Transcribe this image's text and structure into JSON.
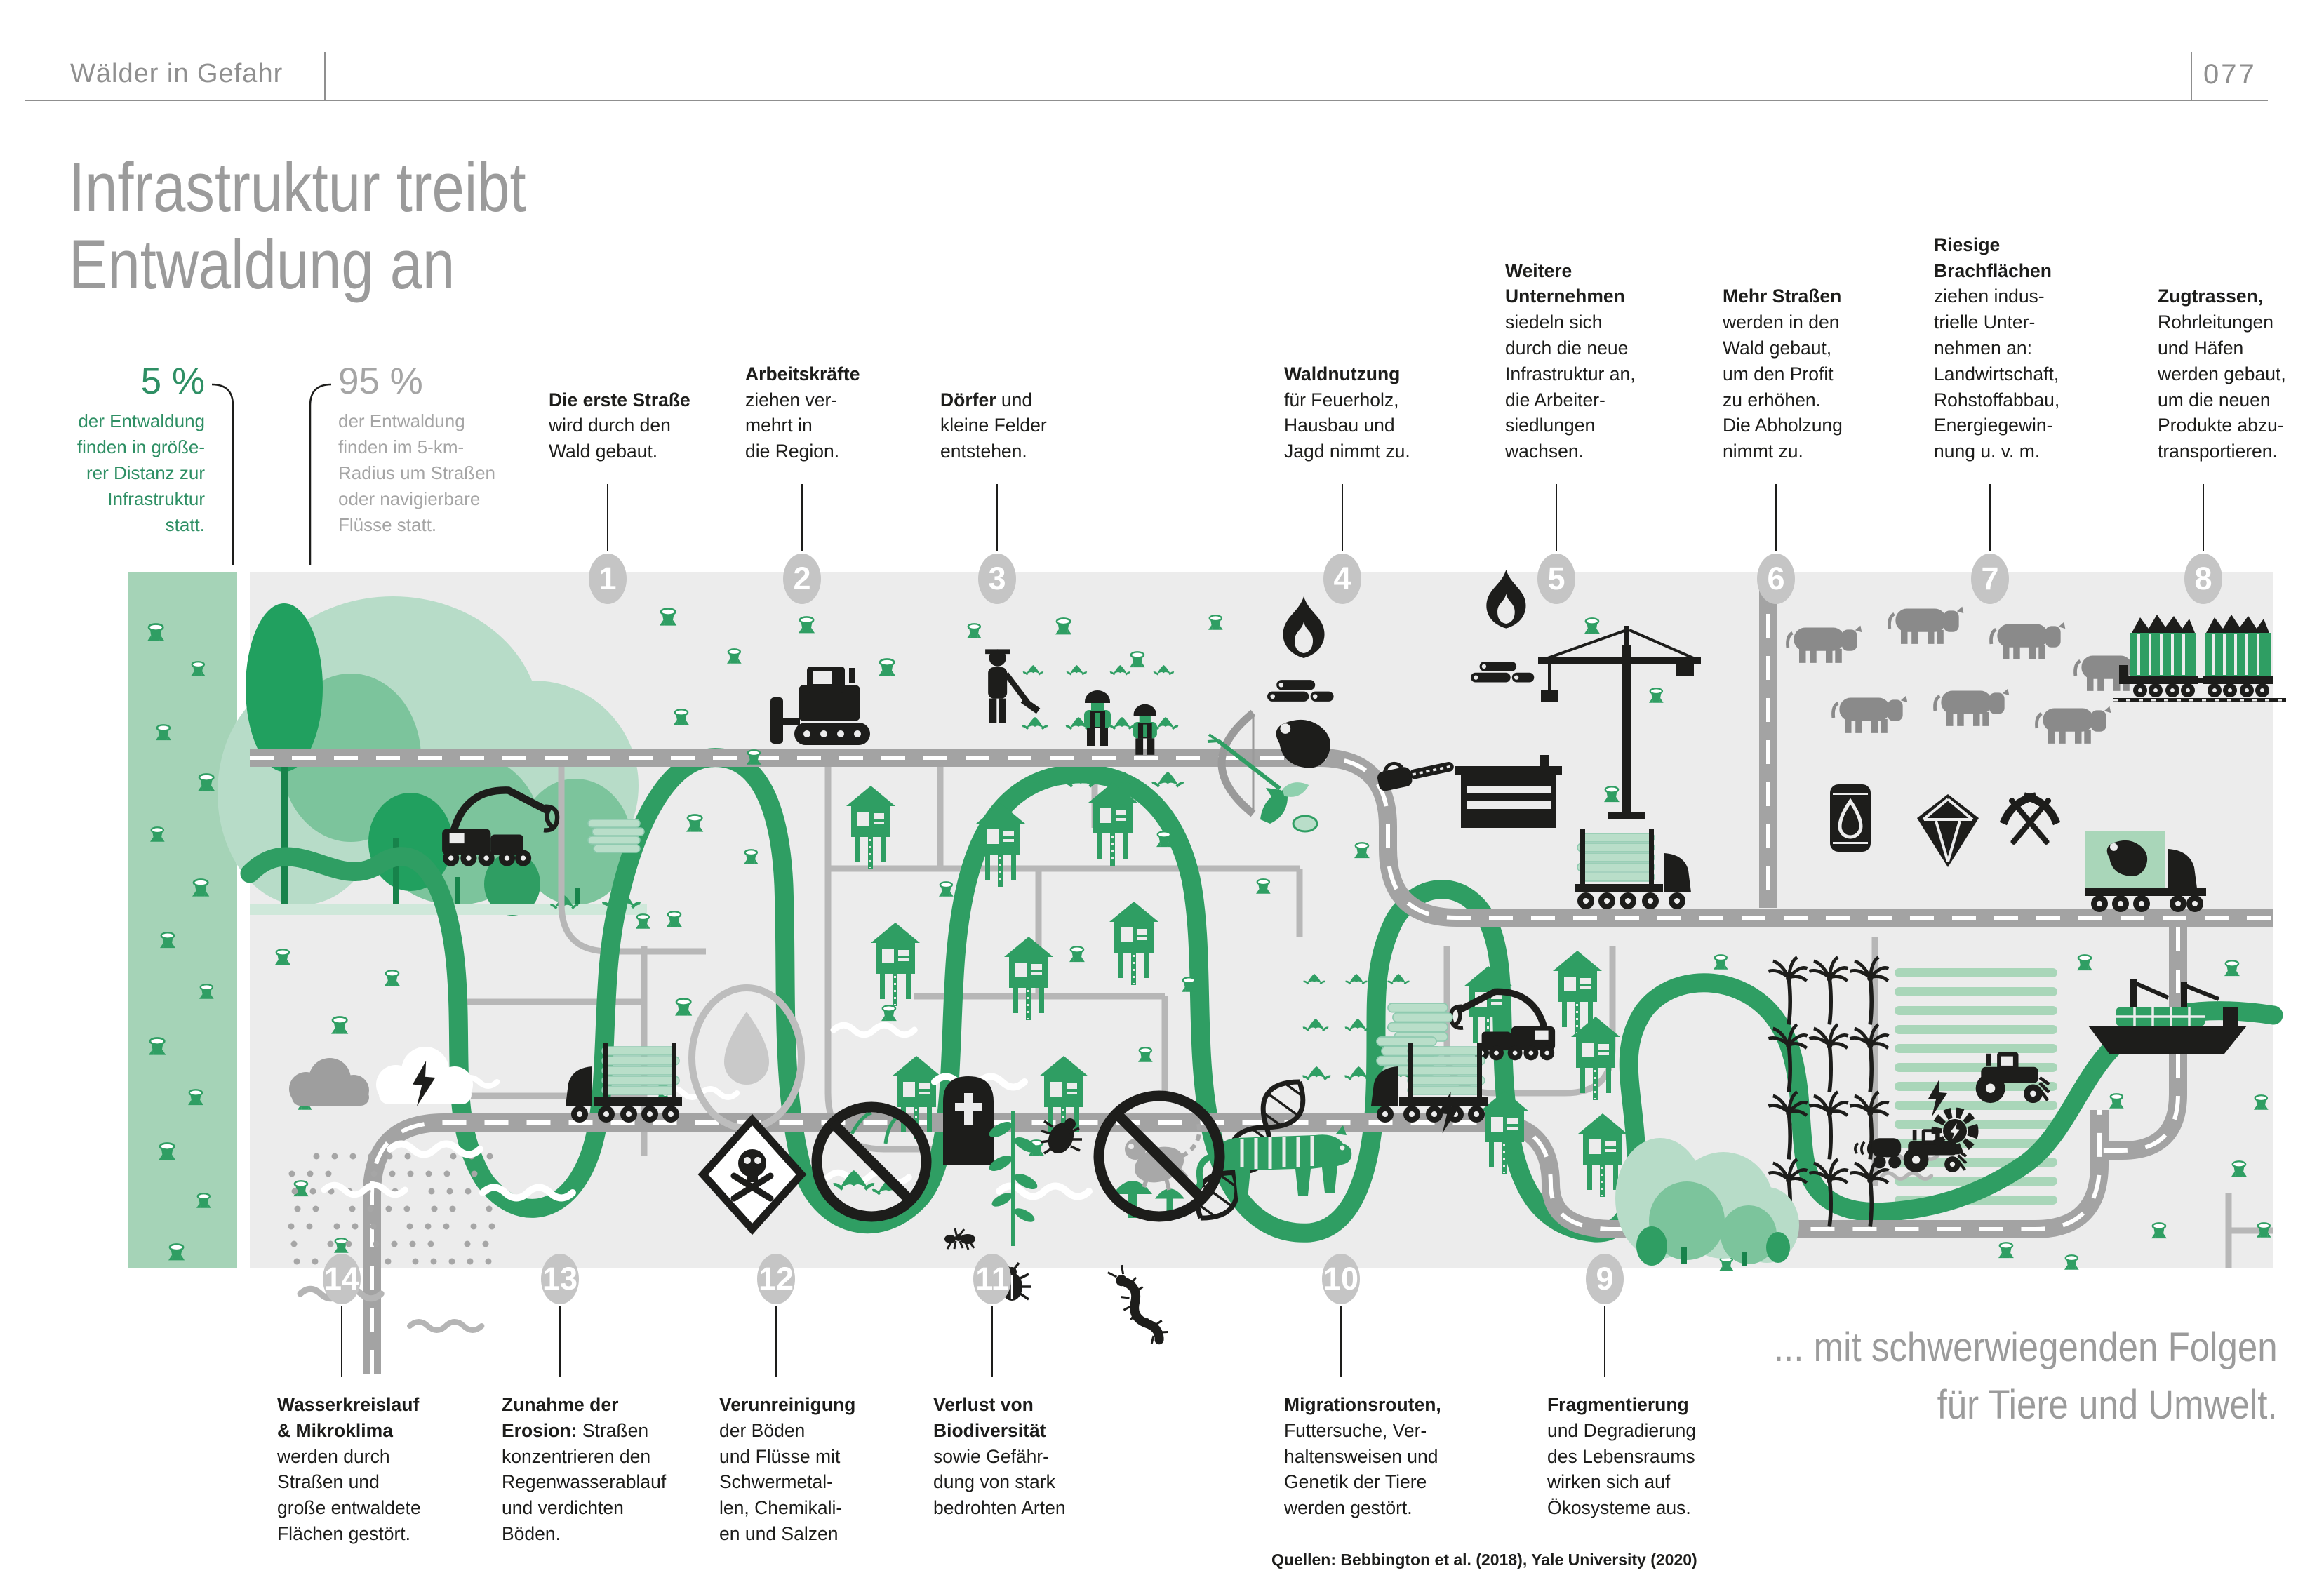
{
  "header": {
    "section_label": "Wälder in Gefahr",
    "page_number": "077"
  },
  "title": {
    "line1": "Infrastruktur treibt",
    "line2": "Entwaldung an"
  },
  "stats": {
    "far": {
      "value": "5 %",
      "lines": [
        "der Entwaldung",
        "finden in größe-",
        "rer Distanz zur",
        "Infrastruktur",
        "statt."
      ]
    },
    "near": {
      "value": "95 %",
      "lines": [
        "der Entwaldung",
        "finden im 5-km-",
        "Radius um Straßen",
        "oder navigierbare",
        "Flüsse statt."
      ]
    }
  },
  "steps_top": [
    {
      "num": "1",
      "lines": [
        "**Die erste Straße**",
        "wird durch den",
        "Wald gebaut."
      ]
    },
    {
      "num": "2",
      "lines": [
        "**Arbeitskräfte**",
        "ziehen ver-",
        "mehrt in",
        "die Region."
      ]
    },
    {
      "num": "3",
      "lines": [
        "**Dörfer** und",
        "kleine Felder",
        "entstehen."
      ]
    },
    {
      "num": "4",
      "lines": [
        "**Waldnutzung**",
        "für Feuerholz,",
        "Hausbau und",
        "Jagd nimmt zu."
      ]
    },
    {
      "num": "5",
      "lines": [
        "**Weitere**",
        "**Unternehmen**",
        "siedeln sich",
        "durch die neue",
        "Infrastruktur an,",
        "die Arbeiter-",
        "siedlungen",
        "wachsen."
      ]
    },
    {
      "num": "6",
      "lines": [
        "**Mehr Straßen**",
        "werden in den",
        "Wald gebaut,",
        "um den Profit",
        "zu erhöhen.",
        "Die Abholzung",
        "nimmt zu."
      ]
    },
    {
      "num": "7",
      "lines": [
        "**Riesige**",
        "**Brachflächen**",
        "ziehen indus-",
        "trielle Unter-",
        "nehmen an:",
        "Landwirtschaft,",
        "Rohstoffabbau,",
        "Energiegewin-",
        "nung u. v. m."
      ]
    },
    {
      "num": "8",
      "lines": [
        "**Zugtrassen,**",
        "Rohrleitungen",
        "und Häfen",
        "werden gebaut,",
        "um die neuen",
        "Produkte abzu-",
        "transportieren."
      ]
    }
  ],
  "steps_bottom": [
    {
      "num": "14",
      "lines": [
        "**Wasserkreislauf**",
        "**& Mikroklima**",
        "werden durch",
        "Straßen und",
        "große entwaldete",
        "Flächen gestört."
      ]
    },
    {
      "num": "13",
      "lines": [
        "**Zunahme der**",
        "**Erosion:** Straßen",
        "konzentrieren den",
        "Regenwasserablauf",
        "und verdichten",
        "Böden."
      ]
    },
    {
      "num": "12",
      "lines": [
        "**Verunreinigung**",
        "der Böden",
        "und Flüsse mit",
        "Schwermetal-",
        "len, Chemikali-",
        "en und Salzen"
      ]
    },
    {
      "num": "11",
      "lines": [
        "**Verlust von**",
        "**Biodiversität**",
        "sowie Gefähr-",
        "dung von stark",
        "bedrohten Arten"
      ]
    },
    {
      "num": "10",
      "lines": [
        "**Migrationsrouten,**",
        "Futtersuche, Ver-",
        "haltensweisen und",
        "Genetik der Tiere",
        "werden gestört."
      ]
    },
    {
      "num": "9",
      "lines": [
        "**Fragmentierung**",
        "und Degradierung",
        "des Lebensraums",
        "wirken sich auf",
        "Ökosysteme aus."
      ]
    }
  ],
  "closing": {
    "line1": "... mit schwerwiegenden Folgen",
    "line2": "für Tiere und Umwelt."
  },
  "source": "Quellen: Bebbington et al. (2018), Yale University (2020)",
  "map_features": [
    "intact-forest-strip",
    "deforested-area",
    "river",
    "roads",
    "tree-stumps",
    "bulldozer",
    "workers",
    "farmer",
    "crop-fields",
    "firewood-fires",
    "chainsaw",
    "stilt-houses",
    "bow-and-arrow",
    "bushmeat",
    "crane",
    "sawmill",
    "log-trucks",
    "harvesters",
    "cattle",
    "oil-barrel",
    "diamond",
    "pickaxes",
    "freight-train",
    "oil-palms",
    "plantation",
    "tractors",
    "cargo-ship",
    "turbine",
    "dna-helix",
    "tiger",
    "rain-clouds",
    "water-drop",
    "poison-sign",
    "no-plants-sign",
    "gravestone",
    "insects",
    "no-primate-sign",
    "mushrooms"
  ],
  "colors": {
    "accent_green": "#2f9e63",
    "light_green": "#a9d6b9",
    "strip_green": "#a5d3b7",
    "pale_green": "#b9dec9",
    "ink": "#1d1d1b",
    "gray_text": "#9b9b9b",
    "map_background": "#ececec",
    "road_gray": "#a3a3a3",
    "badge_gray": "#c5c5c5",
    "stat_green": "#2e8f64",
    "stat_gray": "#a5a5a5",
    "cow_gray": "#8a8a8a"
  }
}
